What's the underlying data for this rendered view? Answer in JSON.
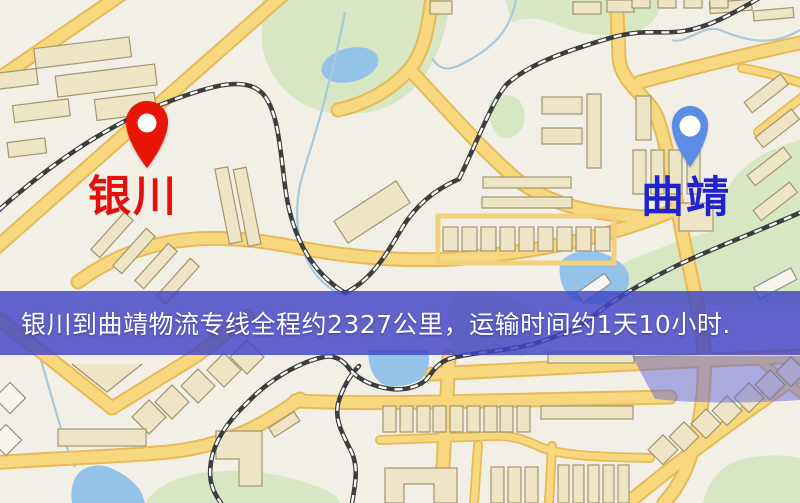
{
  "map": {
    "markers": [
      {
        "id": "origin",
        "label": "银川",
        "pin_color": "#e81405",
        "label_color": "#e5100a"
      },
      {
        "id": "destination",
        "label": "曲靖",
        "pin_color": "#5b8de6",
        "label_color": "#2222cc"
      }
    ],
    "banner": {
      "text": "银川到曲靖物流专线全程约2327公里，运输时间约1天10小时.",
      "background_color": "rgba(64,68,196,0.82)",
      "text_color": "#ffffff"
    },
    "palette": {
      "land": "#f2efe6",
      "road": "#f8d87f",
      "road_casing": "#e7ba58",
      "water": "#93c3e8",
      "park": "#d7e7c3",
      "building": "#eee4c6",
      "building_outline": "#a3966e",
      "railway": "#3d3d3d",
      "banner_bg": "rgba(64,68,196,0.82)",
      "banner_fg": "#ffffff"
    }
  }
}
